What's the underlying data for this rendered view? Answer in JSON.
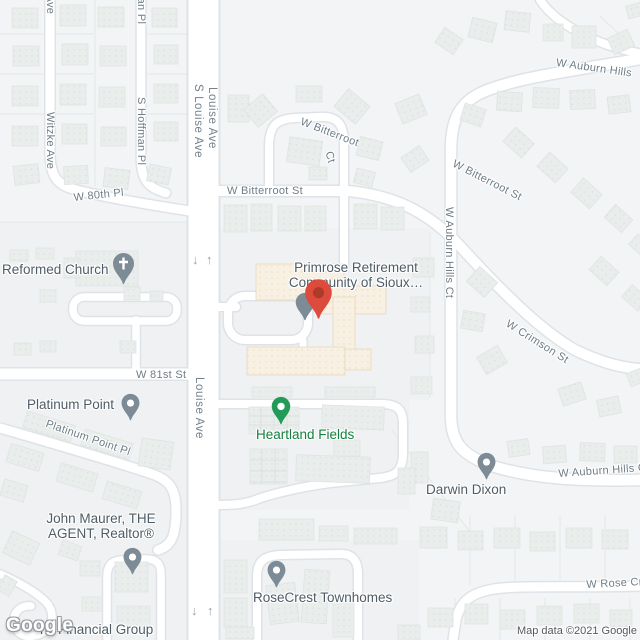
{
  "map": {
    "logo_text": "Google",
    "attribution": "Map data ©2021 Google"
  },
  "streets": {
    "witzke": "Witzke Ave",
    "hoffman": "S Hoffman Pl",
    "s_louise": "S Louise Ave",
    "louise": "Louise Ave",
    "w80th": "W 80th Pl",
    "w81st": "W 81st St",
    "bitterroot_st": "W Bitterroot St",
    "bitterroot_ct_1": "W Bitterroot",
    "bitterroot_ct_2": "Ct",
    "auburn_hills": "W Auburn Hills",
    "auburn_hills_ct": "W Auburn Hills Ct",
    "crimson": "W Crimson St",
    "rose": "W Rose Cr",
    "platinum_pl": "Platinum Point Pl"
  },
  "places": {
    "reformed_church": "Reformed Church",
    "platinum_point": "Platinum Point",
    "primrose_line1": "Primrose Retirement",
    "primrose_line2": "Community of Sioux…",
    "heartland": "Heartland Fields",
    "darwin": "Darwin Dixon",
    "maurer_line1": "John Maurer, THE",
    "maurer_line2": "AGENT, Realtor®",
    "rosecrest": "RoseCrest Townhomes",
    "financial": "nk Financial Group"
  },
  "road_arrows": {
    "down": "↓",
    "up": "↑"
  },
  "colors": {
    "pin_red": "#dd4b3c",
    "pin_red_dot": "#ad3a2b",
    "pin_gray": "#7d8b96",
    "pin_green": "#239b58",
    "poi_label": "#4e5c67",
    "green_label": "#15803d",
    "street_label": "#6e7d87",
    "road_fill": "#ffffff",
    "road_casing": "#dfe3e7",
    "building_fill": "#e9edeb",
    "commercial_building_fill": "#f8f0e2"
  }
}
